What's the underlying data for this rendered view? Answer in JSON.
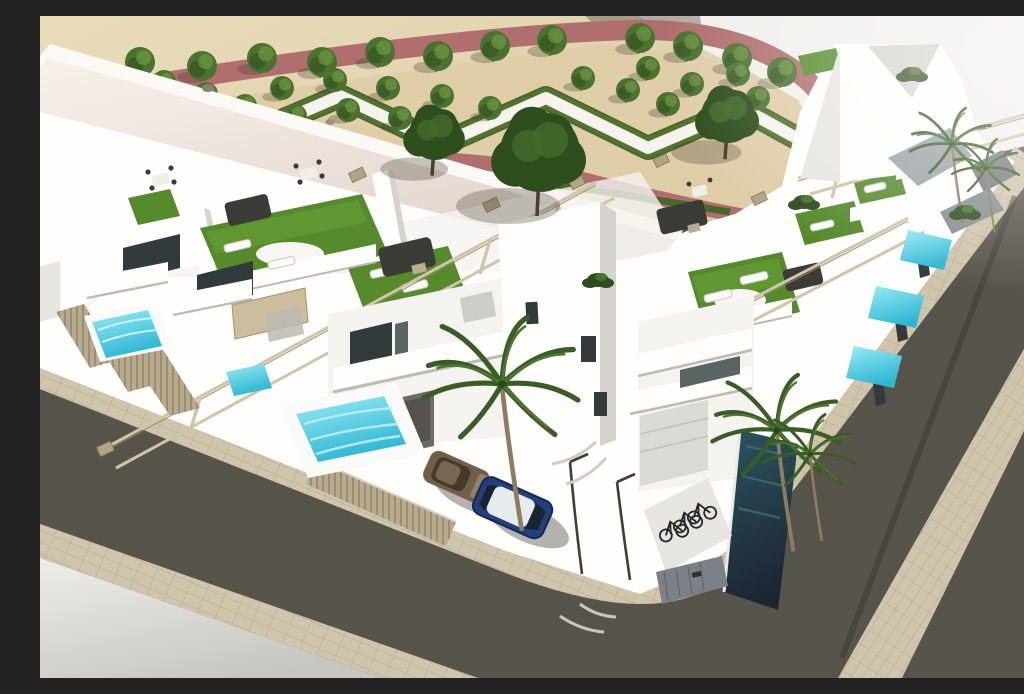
{
  "meta": {
    "title": "Aerial 3D architectural rendering of a modern white residential villa development with rooftop terraces, private pools, a formal landscaped park and a corner street junction"
  },
  "palette": {
    "sand": "#d8c6a1",
    "tan": "#dfcda8",
    "whitepath": "#f5f3ee",
    "pink": "#b06e6f",
    "hedge": "#49682a",
    "hedgehi": "#5f8036",
    "tree": "#4c7230",
    "treedark": "#2f4e1e",
    "treehi": "#6d9440",
    "trunk": "#6e5c41",
    "ground": "#f0efec",
    "white": "#fdfdfc",
    "face": "#f4f3f0",
    "face2": "#e7e5e0",
    "face3": "#d5d3cd",
    "face4": "#bcbab3",
    "win": "#333a3c",
    "win2": "#5a6462",
    "roof": "#ebdfd8",
    "turf": "#568a2c",
    "turfhi": "#6ba33a",
    "turfdark": "#3f6a1f",
    "beam": "#cfc5a9",
    "beamdark": "#93895f",
    "cap": "#b0a583",
    "street": "#57554b",
    "walk": "#cfc4ac",
    "walkline": "#b2a78d",
    "pool": "#7adfee",
    "pooldeep": "#3cc2da",
    "pooldark": "#27535c",
    "fence": "#b7aa8f",
    "fenceline": "#8d8269",
    "sofa": "#3b3b37",
    "carblue": "#23407c",
    "carbronze": "#70604a",
    "bike": "#23262a",
    "door": "#7b8186",
    "shadow": "rgba(70,62,48,.30)"
  },
  "park": {
    "description": "Formal garden with rose-colored paved promenades, white zigzag walkways bordered by clipped hedges, sandy gravel parterres and rows of ornamental trees",
    "tree_rows": {
      "top": [
        [
          38,
          54
        ],
        [
          100,
          46
        ],
        [
          162,
          50
        ],
        [
          222,
          42
        ],
        [
          282,
          46
        ],
        [
          340,
          36
        ],
        [
          398,
          40
        ],
        [
          455,
          30
        ],
        [
          512,
          24
        ],
        [
          600,
          22
        ],
        [
          648,
          30
        ],
        [
          697,
          42
        ],
        [
          742,
          56
        ]
      ],
      "interior": [
        [
          166,
          78
        ],
        [
          124,
          66
        ],
        [
          205,
          90
        ],
        [
          255,
          100
        ],
        [
          308,
          94
        ],
        [
          360,
          102
        ],
        [
          242,
          72
        ],
        [
          295,
          64
        ],
        [
          348,
          72
        ],
        [
          402,
          80
        ],
        [
          450,
          92
        ],
        [
          543,
          62
        ],
        [
          588,
          74
        ],
        [
          628,
          88
        ],
        [
          652,
          68
        ],
        [
          698,
          58
        ],
        [
          718,
          82
        ],
        [
          608,
          52
        ]
      ]
    },
    "large_trees": [
      [
        395,
        118,
        26
      ],
      [
        500,
        136,
        40
      ],
      [
        688,
        100,
        27
      ]
    ],
    "hedge_zigzag": [
      [
        195,
        125
      ],
      [
        300,
        80
      ],
      [
        402,
        128
      ],
      [
        506,
        82
      ],
      [
        608,
        132
      ],
      [
        702,
        92
      ],
      [
        760,
        124
      ]
    ]
  },
  "development": {
    "villas_front_row": 5,
    "villas_back_row": 6,
    "rooftop_terraces": 8,
    "pergola_frames": 3,
    "pools": {
      "turquoise": 6,
      "dark_lap_pool": 1
    },
    "features": [
      "white render facades",
      "dark glazed balconies",
      "artificial turf roof decks",
      "sun loungers",
      "outdoor sofa sets",
      "dining sets",
      "slatted privacy fences",
      "bike storage niche",
      "parking bays",
      "garage doors"
    ]
  },
  "vehicles": {
    "cars": [
      {
        "name": "bronze-hatchback"
      },
      {
        "name": "dark-blue-suv-white-roof"
      }
    ],
    "bicycles": 3
  },
  "vegetation": {
    "palms": [
      [
        462,
        368,
        1.15
      ],
      [
        737,
        414,
        0.95
      ],
      [
        770,
        438,
        0.68
      ],
      [
        912,
        128,
        0.62
      ],
      [
        946,
        152,
        0.5
      ]
    ],
    "bushes": [
      [
        925,
        196
      ],
      [
        764,
        186
      ],
      [
        558,
        264
      ],
      [
        872,
        58
      ]
    ]
  },
  "streets": {
    "layout": "Two dark asphalt streets meeting at a rounded corner, lined with beige paver sidewalks; light paved corner plaza at lower left and open lot at upper right"
  }
}
